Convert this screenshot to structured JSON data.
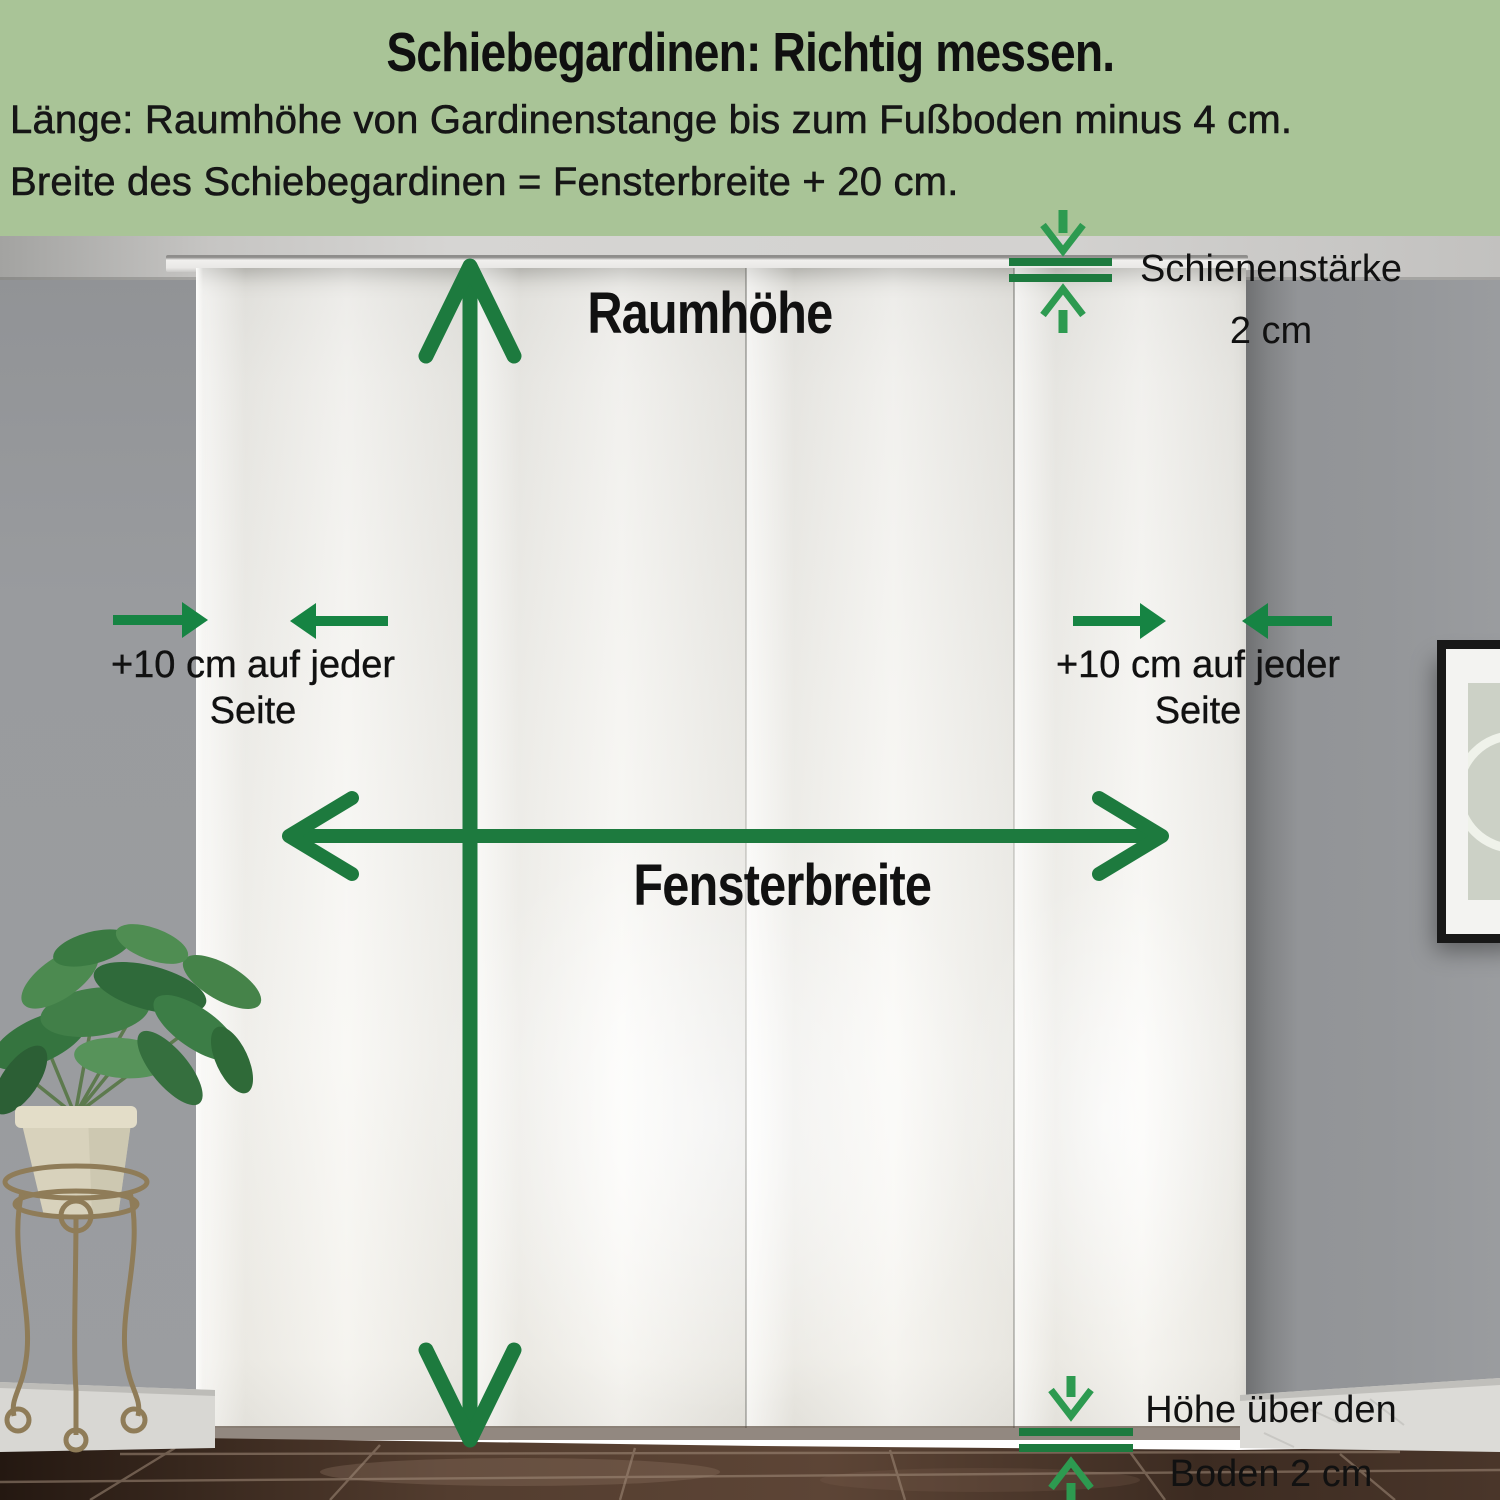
{
  "header": {
    "title": "Schiebegardinen: Richtig messen.",
    "line1": "Länge: Raumhöhe von Gardinenstange bis zum Fußboden minus 4 cm.",
    "line2": "Breite des Schiebegardinen = Fensterbreite + 20 cm."
  },
  "annotations": {
    "room_height": {
      "label": "Raumhöhe",
      "icon": "double-arrow-vertical-icon"
    },
    "window_width": {
      "label": "Fensterbreite",
      "icon": "double-arrow-horizontal-icon"
    },
    "left_margin": {
      "line1": "+10 cm auf jeder",
      "line2": "Seite",
      "icon": "converging-arrows-icon"
    },
    "right_margin": {
      "line1": "+10 cm auf jeder",
      "line2": "Seite",
      "icon": "converging-arrows-icon"
    },
    "rail_thickness": {
      "label": "Schienenstärke",
      "value": "2 cm",
      "icon": "gap-measure-vertical-icon"
    },
    "floor_gap": {
      "line1": "Höhe über den",
      "line2": "Boden 2 cm",
      "icon": "gap-measure-vertical-icon"
    }
  },
  "colors": {
    "header_bg": "#a9c497",
    "arrow_dark": "#1d7a3e",
    "arrow_solid": "#168443",
    "arrow_light": "#2d9a50",
    "ink": "#141414"
  }
}
